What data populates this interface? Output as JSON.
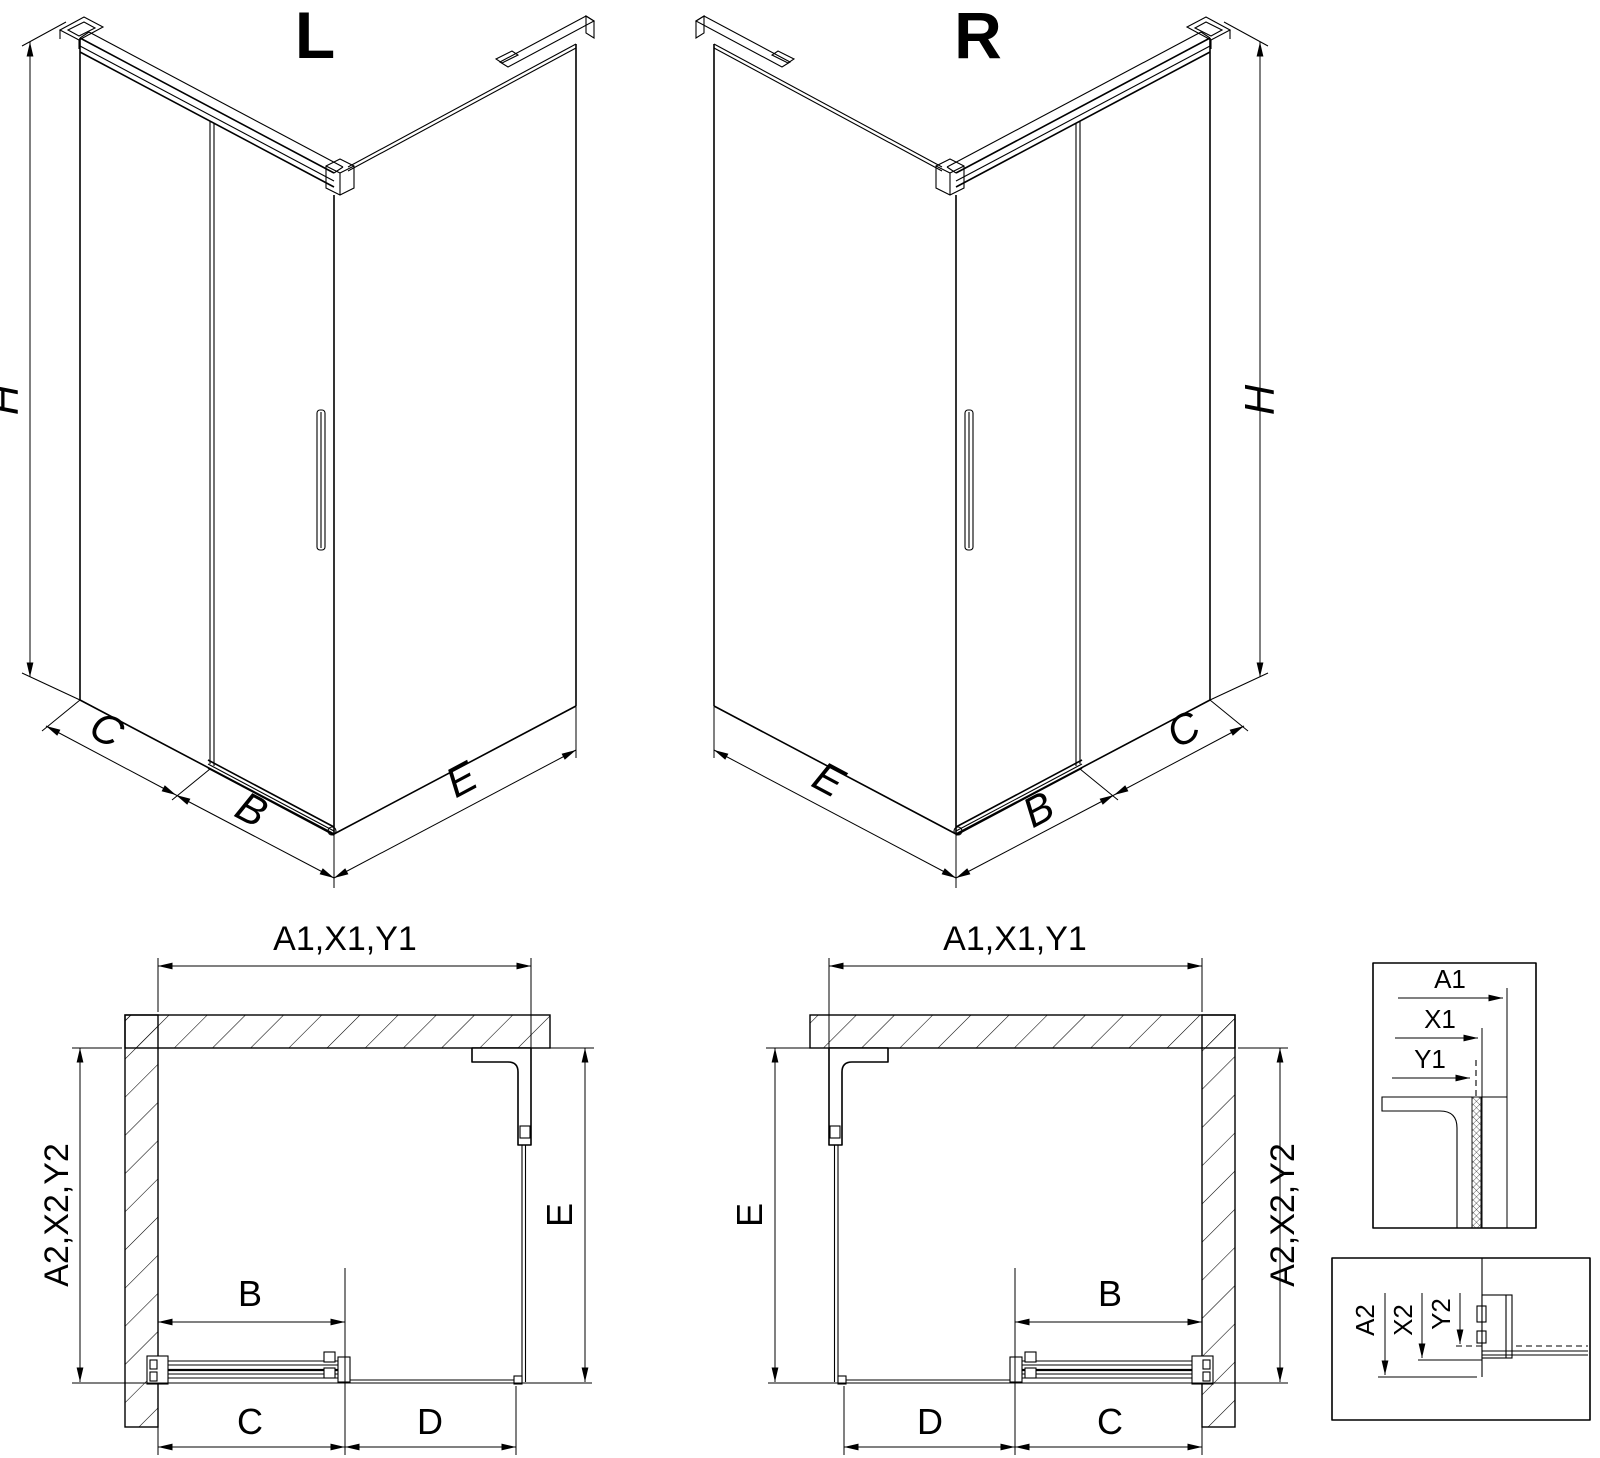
{
  "drawing": {
    "type": "shower-enclosure-technical-drawing",
    "colors": {
      "line": "#000000",
      "background": "#ffffff"
    },
    "views": {
      "iso_left": {
        "title": "L",
        "dim_height": "H",
        "dim_side_wall": "C",
        "dim_door": "B",
        "dim_return_wall": "E"
      },
      "iso_right": {
        "title": "R",
        "dim_height": "H",
        "dim_side_wall": "C",
        "dim_door": "B",
        "dim_return_wall": "E"
      },
      "plan_left": {
        "dim_top": "A1,X1,Y1",
        "dim_left": "A2,X2,Y2",
        "dim_right": "E",
        "dim_door": "B",
        "dim_bottom_first": "C",
        "dim_bottom_second": "D"
      },
      "plan_right": {
        "dim_top": "A1,X1,Y1",
        "dim_right": "A2,X2,Y2",
        "dim_left": "E",
        "dim_door": "B",
        "dim_bottom_first": "D",
        "dim_bottom_second": "C"
      },
      "detail_top": {
        "dims": [
          "A1",
          "X1",
          "Y1"
        ]
      },
      "detail_bottom": {
        "dims": [
          "A2",
          "X2",
          "Y2"
        ]
      }
    }
  }
}
